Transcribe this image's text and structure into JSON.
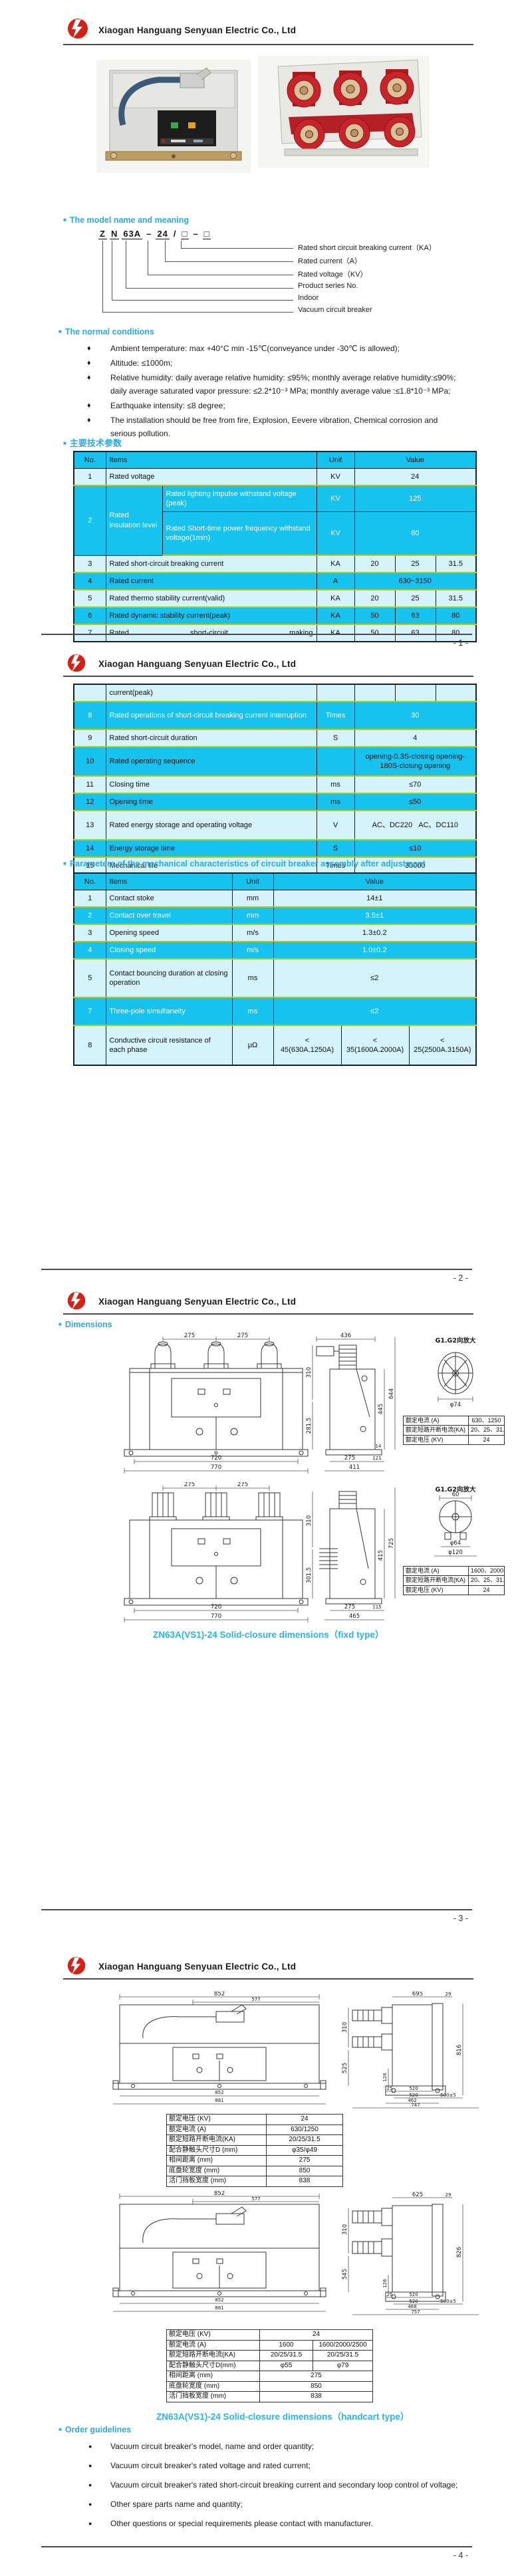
{
  "company": "Xiaogan Hanguang Senyuan Electric Co., Ltd",
  "icons": {
    "square": "■",
    "diamond": "♦",
    "dot": "●"
  },
  "page_numbers": [
    "- 1 -",
    "- 2 -",
    "- 3 -",
    "- 4 -"
  ],
  "colors": {
    "accent_cyan": "#2aabe2",
    "table_header": "#16c2ee",
    "row_pale": "#d4f3fb",
    "row_separator": "#b7cb00",
    "logo_red": "#d42015"
  },
  "model": {
    "heading": "The model name and meaning",
    "parts": [
      "Z",
      "N",
      "63A",
      "–",
      "24",
      "/",
      "□",
      "–",
      "□"
    ],
    "labels": [
      "Rated short circuit breaking current（KA）",
      "Rated current（A）",
      "Rated voltage（KV）",
      "Product series No.",
      "Indoor",
      "Vacuum circuit breaker"
    ]
  },
  "normal": {
    "heading": "The normal conditions",
    "items": [
      "Ambient temperature: max +40°C min -15℃(conveyance under -30℃  is allowed);",
      "Altitude: ≤1000m;",
      "Relative humidity: daily average relative humidity: ≤95%; monthly average relative humidity:≤90%; daily average saturated vapor pressure: ≤2.2*10⁻³ MPa; monthly average value :≤1.8*10⁻³ MPa;",
      "Earthquake intensity: ≤8 degree;",
      "The installation should be free from fire, Explosion, Eevere vibration, Chemical corrosion and serious pollution."
    ]
  },
  "tech": {
    "heading": "主要技术参数",
    "cols": {
      "no": "No.",
      "items": "Items",
      "unit": "Unit",
      "value": "Value"
    },
    "rows": {
      "r1": {
        "no": "1",
        "item": "Rated voltage",
        "unit": "KV",
        "value": "24"
      },
      "r2": {
        "no": "2",
        "item": "Rated insulation level",
        "sub1": {
          "item": "Rated lighting impulse withstand voltage (peak)",
          "unit": "KV",
          "value": "125"
        },
        "sub2": {
          "item": "Rated Short-time power frequency withstand voltage(1min)",
          "unit": "KV",
          "value": "60"
        }
      },
      "r3": {
        "no": "3",
        "item": "Rated short-circuit breaking current",
        "unit": "KA",
        "v1": "20",
        "v2": "25",
        "v3": "31.5"
      },
      "r4": {
        "no": "4",
        "item": "Rated current",
        "unit": "A",
        "value": "630~3150"
      },
      "r5": {
        "no": "5",
        "item": "Rated thermo stability current(valid)",
        "unit": "KA",
        "v1": "20",
        "v2": "25",
        "v3": "31.5"
      },
      "r6": {
        "no": "6",
        "item": "Rated dynamic stability current(peak)",
        "unit": "KA",
        "v1": "50",
        "v2": "63",
        "v3": "80"
      },
      "r7": {
        "no": "7",
        "item": "Rated short-circuit making",
        "cont": "current(peak)",
        "unit": "KA",
        "v1": "50",
        "v2": "63",
        "v3": "80"
      },
      "r8": {
        "no": "8",
        "item": "Rated operations of short-circuit breaking current interruption",
        "unit": "Times",
        "value": "30"
      },
      "r9": {
        "no": "9",
        "item": "Rated short-circuit duration",
        "unit": "S",
        "value": "4"
      },
      "r10": {
        "no": "10",
        "item": "Rated operating sequence",
        "unit": "",
        "value": "opening-0.3S-closing opening-180S-closing opening"
      },
      "r11": {
        "no": "11",
        "item": "Closing time",
        "unit": "ms",
        "value": "≤70"
      },
      "r12": {
        "no": "12",
        "item": "Opening time",
        "unit": "ms",
        "value": "≤50"
      },
      "r13": {
        "no": "13",
        "item": "Rated energy storage and operating voltage",
        "unit": "V",
        "value": "AC、DC220   AC、DC110"
      },
      "r14": {
        "no": "14",
        "item": "Energy storage time",
        "unit": "S",
        "value": "≤10"
      },
      "r15": {
        "no": "15",
        "item": "Mechanical life",
        "unit": "Times",
        "value": "30000"
      }
    }
  },
  "mech": {
    "heading": "Parameters of the mechanical characteristics of circuit breaker assembly after adjustment",
    "cols": {
      "no": "No.",
      "items": "Items",
      "unit": "Unit",
      "value": "Value"
    },
    "rows": {
      "r1": {
        "no": "1",
        "item": "Contact stoke",
        "unit": "mm",
        "value": "14±1"
      },
      "r2": {
        "no": "2",
        "item": "Contact over travel",
        "unit": "mm",
        "value": "3.5±1"
      },
      "r3": {
        "no": "3",
        "item": "Opening speed",
        "unit": "m/s",
        "value": "1.3±0.2"
      },
      "r4": {
        "no": "4",
        "item": "Closing speed",
        "unit": "m/s",
        "value": "1.0±0.2"
      },
      "r5": {
        "no": "5",
        "item": "Contact bouncing duration at closing operation",
        "unit": "ms",
        "value": "≤2"
      },
      "r7": {
        "no": "7",
        "item": "Three-pole simultaneity",
        "unit": "ms",
        "value": "≤2"
      },
      "r8": {
        "no": "8",
        "item": "Conductive circuit resistance of each phase",
        "unit": "μΩ",
        "v1": {
          "lt": "<",
          "v": "45(630A.1250A)"
        },
        "v2": {
          "lt": "<",
          "v": "35(1600A.2000A)"
        },
        "v3": {
          "lt": "<",
          "v": "25(2500A.3150A)"
        }
      }
    }
  },
  "dims": {
    "heading": "Dimensions",
    "detail_title": "G1.G2向放大",
    "caption_fixed": "ZN63A(VS1)-24 Solid-closure dimensions（fixd type）",
    "caption_handcart": "ZN63A(VS1)-24 Solid-closure dimensions（handcart type）",
    "setA": {
      "t1": "275",
      "t2": "275",
      "b1": "720",
      "b2": "770",
      "st": "436",
      "l1": "310",
      "l2": "281.5",
      "r1": "644",
      "r2": "445",
      "s14": "14",
      "sb1": "275",
      "sb2": "121",
      "sb3": "411",
      "dd": "φ74"
    },
    "tabA": [
      {
        "k": "额定电流 (A)",
        "v": "630、1250"
      },
      {
        "k": "额定短路开断电流(KA)",
        "v": "20、25、31.5"
      },
      {
        "k": "额定电压 (KV)",
        "v": "24"
      }
    ],
    "setB": {
      "t1": "275",
      "t2": "275",
      "b1": "720",
      "b2": "770",
      "l1": "310",
      "l2": "301.5",
      "r1": "725",
      "r2": "415",
      "sb1": "275",
      "sb2": "115",
      "sb3": "465",
      "dw": "60",
      "dd1": "φ64",
      "dd2": "φ120"
    },
    "tabB": [
      {
        "k": "额定电流 (A)",
        "v": "1600、2000、2500"
      },
      {
        "k": "额定短路开断电流(KA)",
        "v": "20、25、31.5"
      },
      {
        "k": "额定电压 (KV)",
        "v": "24"
      }
    ],
    "setC": {
      "ft1": "852",
      "ft2": "577",
      "fb1": "852",
      "fb2": "881",
      "st1": "695",
      "st2": "29",
      "l1": "310",
      "l2": "525",
      "m": "126",
      "r": "816",
      "b1": "25",
      "b2": "520",
      "b3": "520",
      "b4": "500±5",
      "b5": "462",
      "b6": "747"
    },
    "tabC": [
      {
        "k": "额定电压 (KV)",
        "v": "24"
      },
      {
        "k": "额定电流 (A)",
        "v": "630/1250"
      },
      {
        "k": "额定短路开断电流(KA)",
        "v": "20/25/31.5"
      },
      {
        "k": "配合静触头尺寸D (mm)",
        "v": "φ35/φ49"
      },
      {
        "k": "相间距离 (mm)",
        "v": "275"
      },
      {
        "k": "底盘轮宽度 (mm)",
        "v": "850"
      },
      {
        "k": "活门挡板宽度 (mm)",
        "v": "838"
      }
    ],
    "setD": {
      "ft1": "852",
      "ft2": "577",
      "fb1": "852",
      "fb2": "881",
      "st1": "625",
      "st2": "29",
      "l1": "310",
      "l2": "545",
      "m": "126",
      "r": "826",
      "b1": "25",
      "b2": "520",
      "b3": "520",
      "b4": "500±5",
      "b5": "468",
      "b6": "757"
    },
    "tabD": [
      {
        "k": "额定电压 (KV)",
        "v1": "24",
        "v2": ""
      },
      {
        "k": "额定电流 (A)",
        "v1": "1600",
        "v2": "1600/2000/2500"
      },
      {
        "k": "额定短路开断电流(KA)",
        "v1": "20/25/31.5",
        "v2": "20/25/31.5"
      },
      {
        "k": "配合静触头尺寸D(mm)",
        "v1": "φ55",
        "v2": "φ79"
      },
      {
        "k": "相间距离 (mm)",
        "v1": "275",
        "v2": ""
      },
      {
        "k": "底盘轮宽度 (mm)",
        "v1": "850",
        "v2": ""
      },
      {
        "k": "活门挡板宽度 (mm)",
        "v1": "838",
        "v2": ""
      }
    ]
  },
  "order": {
    "heading": "Order guidelines",
    "items": [
      "Vacuum circuit breaker's  model, name and order quantity;",
      "Vacuum circuit breaker's rated voltage and rated current;",
      "Vacuum circuit breaker's rated short-circuit breaking current and secondary loop control of voltage;",
      "Other spare parts name and quantity;",
      "Other questions or special requirements please contact with manufacturer."
    ]
  }
}
